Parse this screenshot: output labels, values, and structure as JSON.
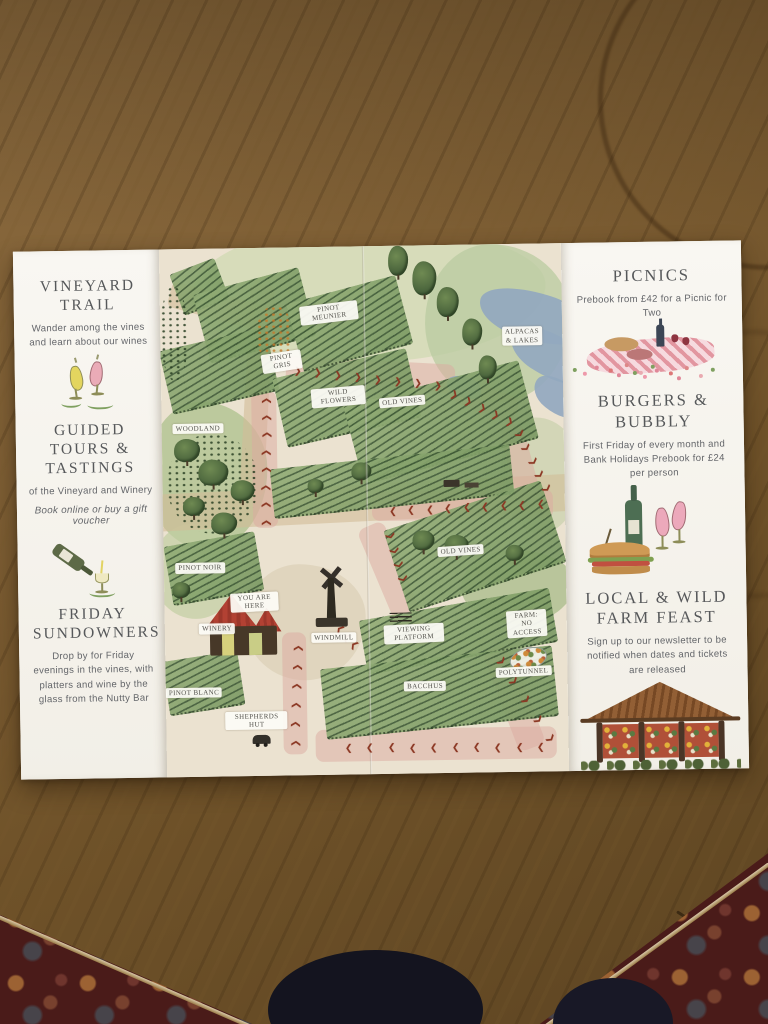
{
  "left_panel": {
    "sections": [
      {
        "title": "VINEYARD TRAIL",
        "body": "Wander among the vines and learn about our wines"
      },
      {
        "title": "GUIDED TOURS & TASTINGS",
        "body": "of the Vineyard and Winery",
        "note": "Book online or buy a gift voucher"
      },
      {
        "title": "FRIDAY SUNDOWNERS",
        "body": "Drop by for Friday evenings in the vines, with platters and wine by the glass from the Nutty Bar"
      }
    ]
  },
  "right_panel": {
    "sections": [
      {
        "title": "PICNICS",
        "body": "Prebook from £42 for a Picnic for Two"
      },
      {
        "title": "BURGERS & BUBBLY",
        "body": "First Friday of every month and Bank Holidays Prebook for £24 per person"
      },
      {
        "title": "LOCAL & WILD FARM FEAST",
        "body": "Sign up to our newsletter to be notified when dates and tickets are released"
      }
    ]
  },
  "map": {
    "labels": [
      {
        "text": "PINOT MEUNIER",
        "x": 42,
        "y": 12.5,
        "rot": -6,
        "w": 52
      },
      {
        "text": "PINOT GRIS",
        "x": 30,
        "y": 21.5,
        "rot": -8,
        "w": 34
      },
      {
        "text": "WILD FLOWERS",
        "x": 44,
        "y": 28.5,
        "rot": -4,
        "w": 48
      },
      {
        "text": "OLD VINES",
        "x": 60,
        "y": 29.5,
        "rot": -4,
        "w": 60
      },
      {
        "text": "ALPACAS & LAKES",
        "x": 90,
        "y": 17.5,
        "rot": 0,
        "w": 50
      },
      {
        "text": "WOODLAND",
        "x": 9,
        "y": 34,
        "rot": 0,
        "w": 70
      },
      {
        "text": "PINOT NOIR",
        "x": 9,
        "y": 60.5,
        "rot": 0,
        "w": 70
      },
      {
        "text": "YOU ARE HERE",
        "x": 22.5,
        "y": 67,
        "rot": -2,
        "w": 42
      },
      {
        "text": "WINERY",
        "x": 13,
        "y": 72,
        "rot": 0,
        "w": 60
      },
      {
        "text": "WINDMILL",
        "x": 42,
        "y": 74,
        "rot": 0,
        "w": 60
      },
      {
        "text": "OLD VINES",
        "x": 74,
        "y": 58,
        "rot": -3,
        "w": 60
      },
      {
        "text": "VIEWING PLATFORM",
        "x": 62,
        "y": 73.5,
        "rot": -2,
        "w": 54
      },
      {
        "text": "FARM: NO ACCESS",
        "x": 90,
        "y": 72,
        "rot": -3,
        "w": 50
      },
      {
        "text": "POLYTUNNEL",
        "x": 89,
        "y": 81,
        "rot": -2,
        "w": 70
      },
      {
        "text": "PINOT BLANC",
        "x": 7,
        "y": 84,
        "rot": 0,
        "w": 72
      },
      {
        "text": "SHEPHERDS HUT",
        "x": 22.5,
        "y": 89.5,
        "rot": 0,
        "w": 56
      },
      {
        "text": "BACCHUS",
        "x": 64.5,
        "y": 83.5,
        "rot": 0,
        "w": 60
      }
    ],
    "arrow_glyph": "❯",
    "trail": [
      {
        "x": 34,
        "y": 23.5,
        "dx": 5.0,
        "dy": 0.45,
        "angle": 5,
        "n": 8
      },
      {
        "x": 73,
        "y": 28.5,
        "dx": 3.4,
        "dy": 1.3,
        "angle": 22,
        "n": 5
      },
      {
        "x": 89,
        "y": 36,
        "dx": 1.6,
        "dy": 2.6,
        "angle": 58,
        "n": 5
      },
      {
        "x": 94,
        "y": 49.5,
        "dx": -4.6,
        "dy": 0.1,
        "angle": 180,
        "n": 9
      },
      {
        "x": 25.5,
        "y": 52,
        "dx": 0.1,
        "dy": -3.3,
        "angle": -88,
        "n": 8
      },
      {
        "x": 32,
        "y": 94,
        "dx": 0.2,
        "dy": -3.6,
        "angle": -86,
        "n": 6
      },
      {
        "x": 47,
        "y": 75.5,
        "dx": -1.7,
        "dy": -1.5,
        "angle": -140,
        "n": 3
      },
      {
        "x": 93,
        "y": 95.5,
        "dx": -5.3,
        "dy": -0.05,
        "angle": 180,
        "n": 10
      },
      {
        "x": 83.5,
        "y": 79,
        "dx": 3.0,
        "dy": 3.7,
        "angle": 52,
        "n": 5
      },
      {
        "x": 56.5,
        "y": 55,
        "dx": 1.0,
        "dy": 2.7,
        "angle": 72,
        "n": 4
      }
    ]
  },
  "colors": {
    "paper": "#f6f4ee",
    "heading_gray": "#56585a",
    "body_gray": "#64666a",
    "arrow_red": "#8c3824",
    "label_pill": "#fcfbf5",
    "vineyard_green": "#7b9a63",
    "lake_blue": "#92a8bf",
    "trail_pink": "#dcaaa0",
    "winery_roof_red": "#b24133",
    "wood_brown": "#7c5d33",
    "carpet_red": "#4a1b19"
  }
}
